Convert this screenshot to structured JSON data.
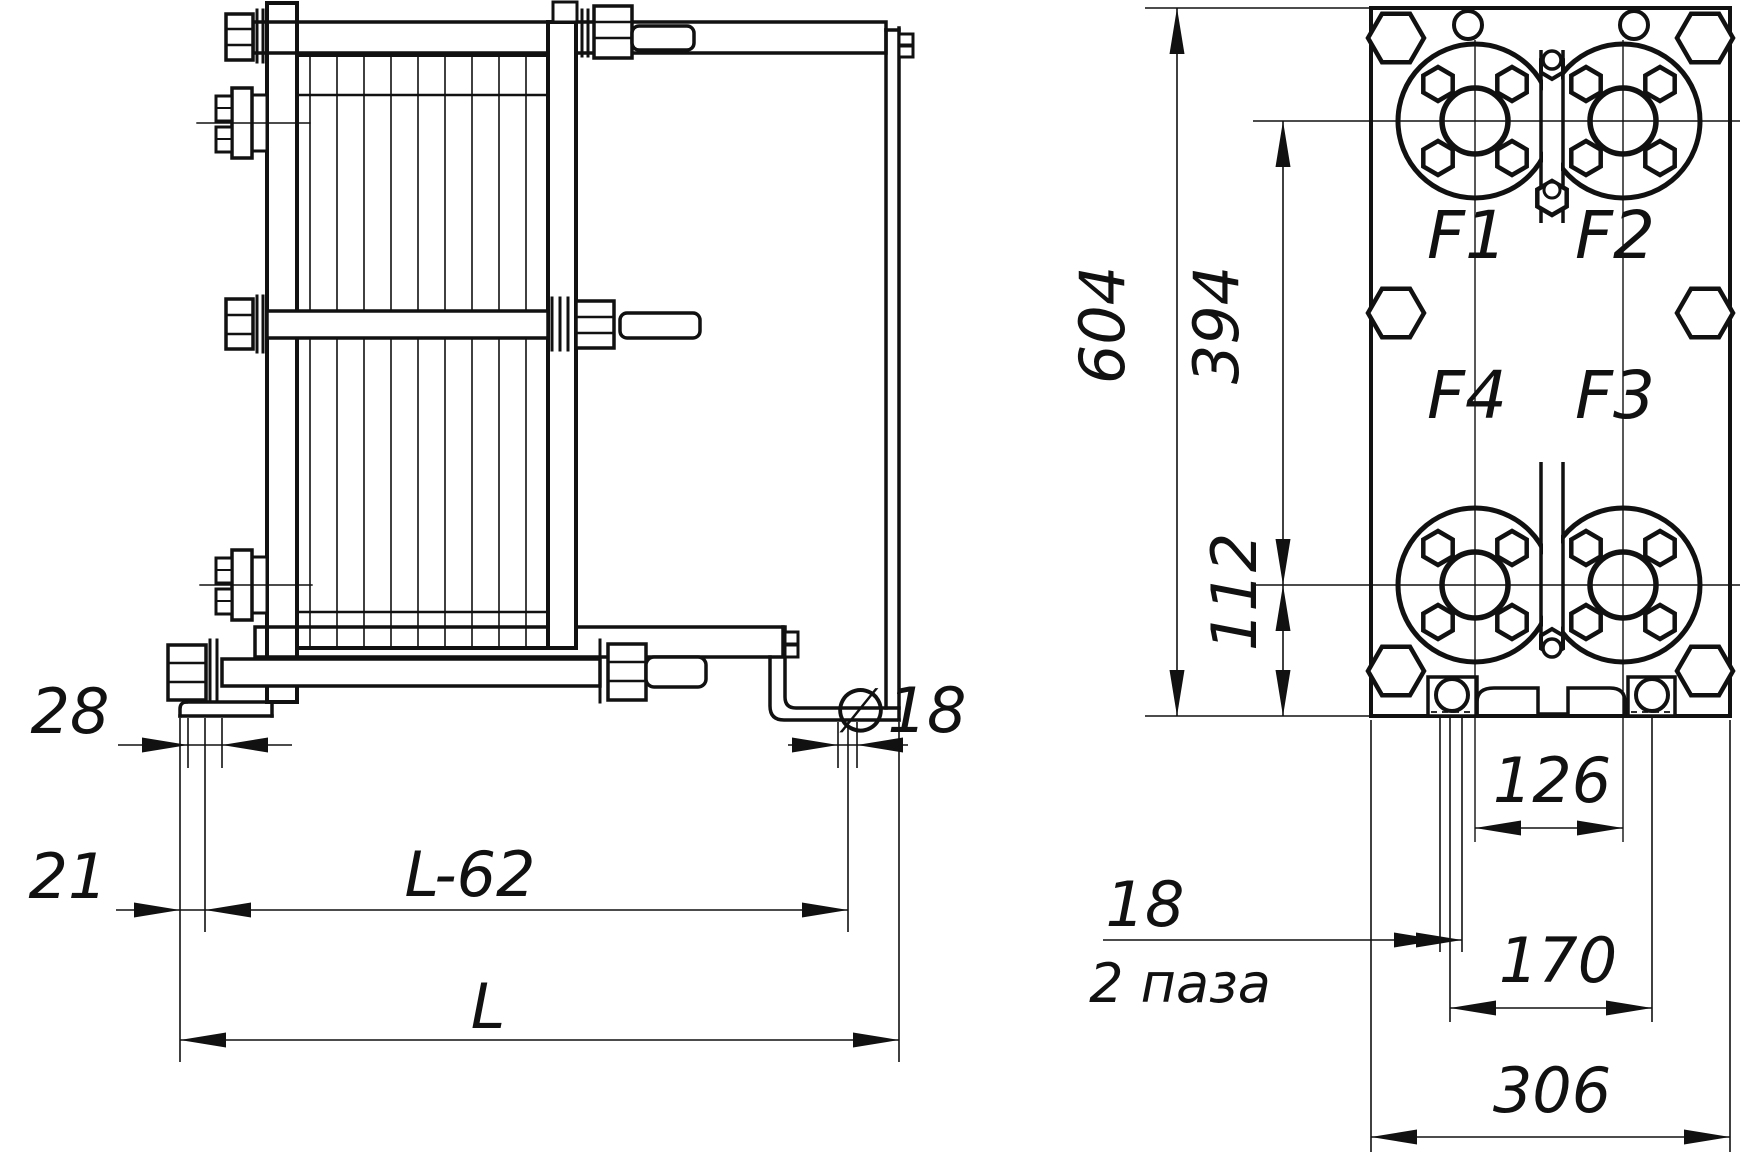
{
  "drawing": {
    "kind": "plate heat exchanger dimensional drawing",
    "ink_color": "#111111",
    "paper_color": "#ffffff",
    "labels": {
      "d28": "28",
      "d21": "21",
      "dL62": "L-62",
      "dL": "L",
      "dDia18": "∅18",
      "d604": "604",
      "d394": "394",
      "d112": "112",
      "d126": "126",
      "d170": "170",
      "d306": "306",
      "d18": "18",
      "slots_note": "2 паза",
      "f1": "F1",
      "f2": "F2",
      "f3": "F3",
      "f4": "F4"
    }
  }
}
